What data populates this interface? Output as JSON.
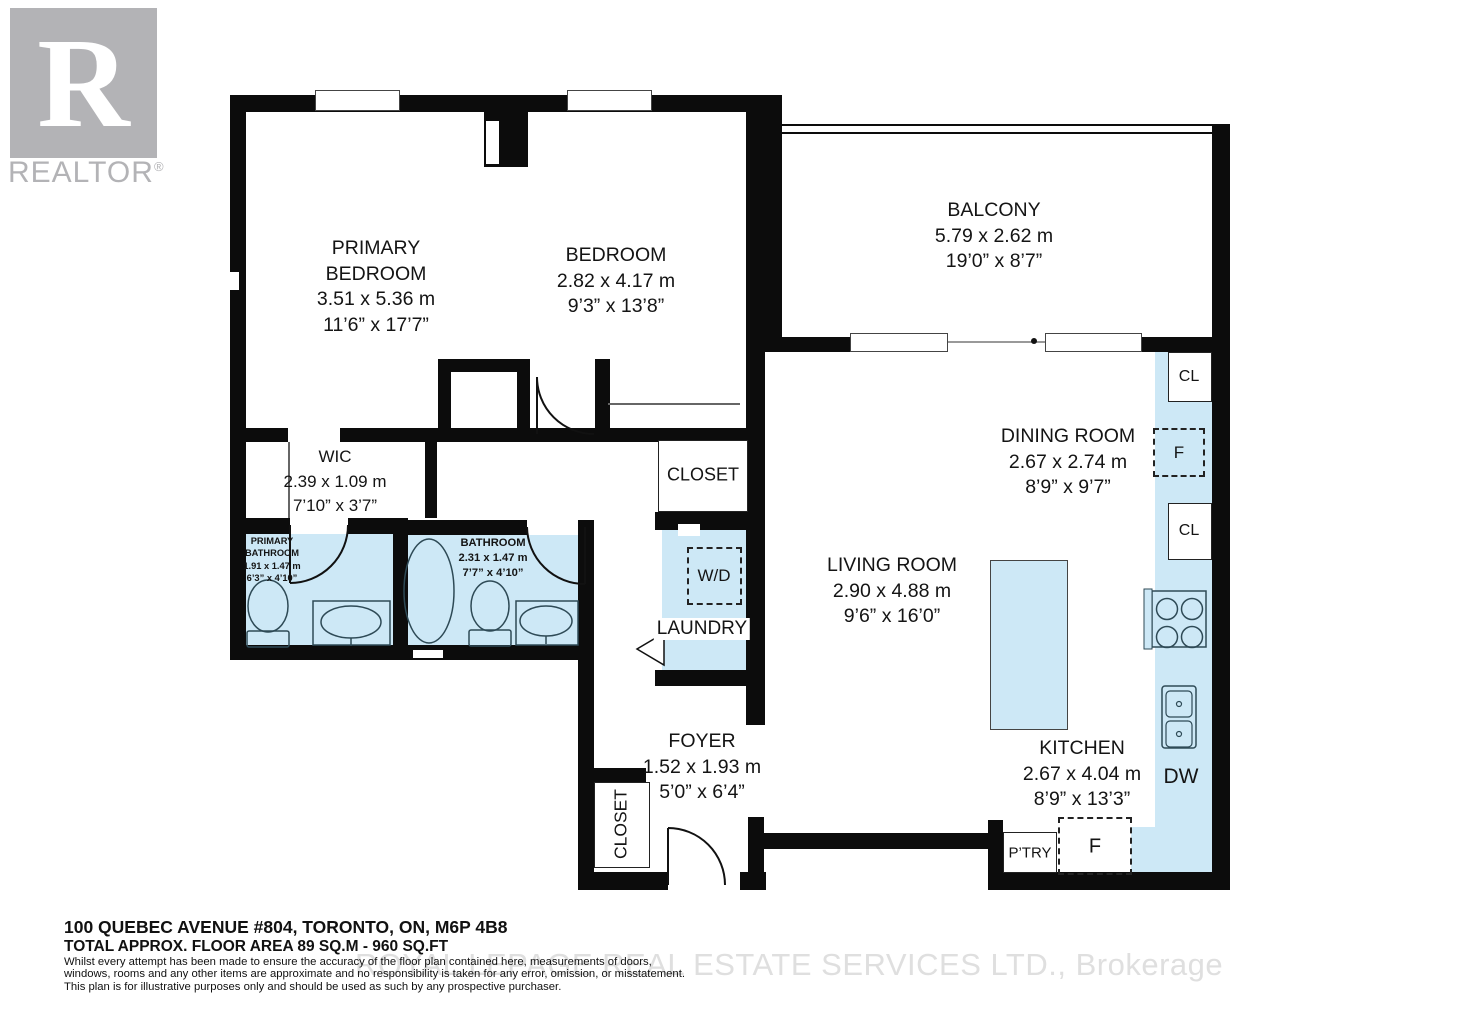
{
  "branding": {
    "logo_letter": "R",
    "logo_text": "REALTOR",
    "registered": "®"
  },
  "rooms": {
    "primary_bedroom": {
      "line1": "PRIMARY",
      "line2": "BEDROOM",
      "metric": "3.51 x 5.36 m",
      "imperial": "11’6” x 17’7”"
    },
    "bedroom": {
      "name": "BEDROOM",
      "metric": "2.82 x 4.17 m",
      "imperial": "9’3” x 13’8”"
    },
    "balcony": {
      "name": "BALCONY",
      "metric": "5.79 x 2.62 m",
      "imperial": "19’0” x 8’7”"
    },
    "dining_room": {
      "name": "DINING ROOM",
      "metric": "2.67 x 2.74 m",
      "imperial": "8’9” x 9’7”"
    },
    "living_room": {
      "name": "LIVING ROOM",
      "metric": "2.90 x 4.88 m",
      "imperial": "9’6” x 16’0”"
    },
    "kitchen": {
      "name": "KITCHEN",
      "metric": "2.67 x 4.04 m",
      "imperial": "8’9” x 13’3”"
    },
    "foyer": {
      "name": "FOYER",
      "metric": "1.52 x 1.93 m",
      "imperial": "5’0” x 6’4”"
    },
    "wic": {
      "name": "WIC",
      "metric": "2.39 x 1.09 m",
      "imperial": "7’10” x 3’7”"
    },
    "primary_bathroom": {
      "line1": "PRIMARY",
      "line2": "BATHROOM",
      "metric": "1.91 x 1.47 m",
      "imperial": "6’3” x 4’10”"
    },
    "bathroom": {
      "name": "BATHROOM",
      "metric": "2.31 x 1.47 m",
      "imperial": "7’7” x 4’10”"
    }
  },
  "features": {
    "closet_bedroom": "CLOSET",
    "closet_foyer": "CLOSET",
    "closet_hall": "CLOSET",
    "laundry": "LAUNDRY",
    "washer_dryer": "W/D",
    "dishwasher": "DW",
    "pantry": "P’TRY",
    "fridge_kitchen": "F",
    "fridge_counter": "F",
    "closet_upper": "CL",
    "closet_lower": "CL"
  },
  "footer": {
    "address": "100 QUEBEC AVENUE #804, TORONTO, ON, M6P 4B8",
    "area": "TOTAL APPROX. FLOOR AREA 89 SQ.M - 960 SQ.FT",
    "disclaimer_line1": "Whilst every attempt has been made to ensure the accuracy of the floor plan contained here, measurements of doors,",
    "disclaimer_line2": "windows, rooms and any other items are approximate and no responsibility is taken for any error, omission, or misstatement.",
    "disclaimer_line3": "This plan is for illustrative purposes only and should be used as such by any prospective purchaser.",
    "watermark": "ROYAL LEPAGE REAL ESTATE SERVICES LTD., Brokerage"
  },
  "colors": {
    "wall": "#0c0c0c",
    "room_fill": "#cde8f6",
    "fixture_stroke": "#2e4a56",
    "logo_gray": "#b3b3b6",
    "watermark_gray": "#dfdfdf"
  }
}
